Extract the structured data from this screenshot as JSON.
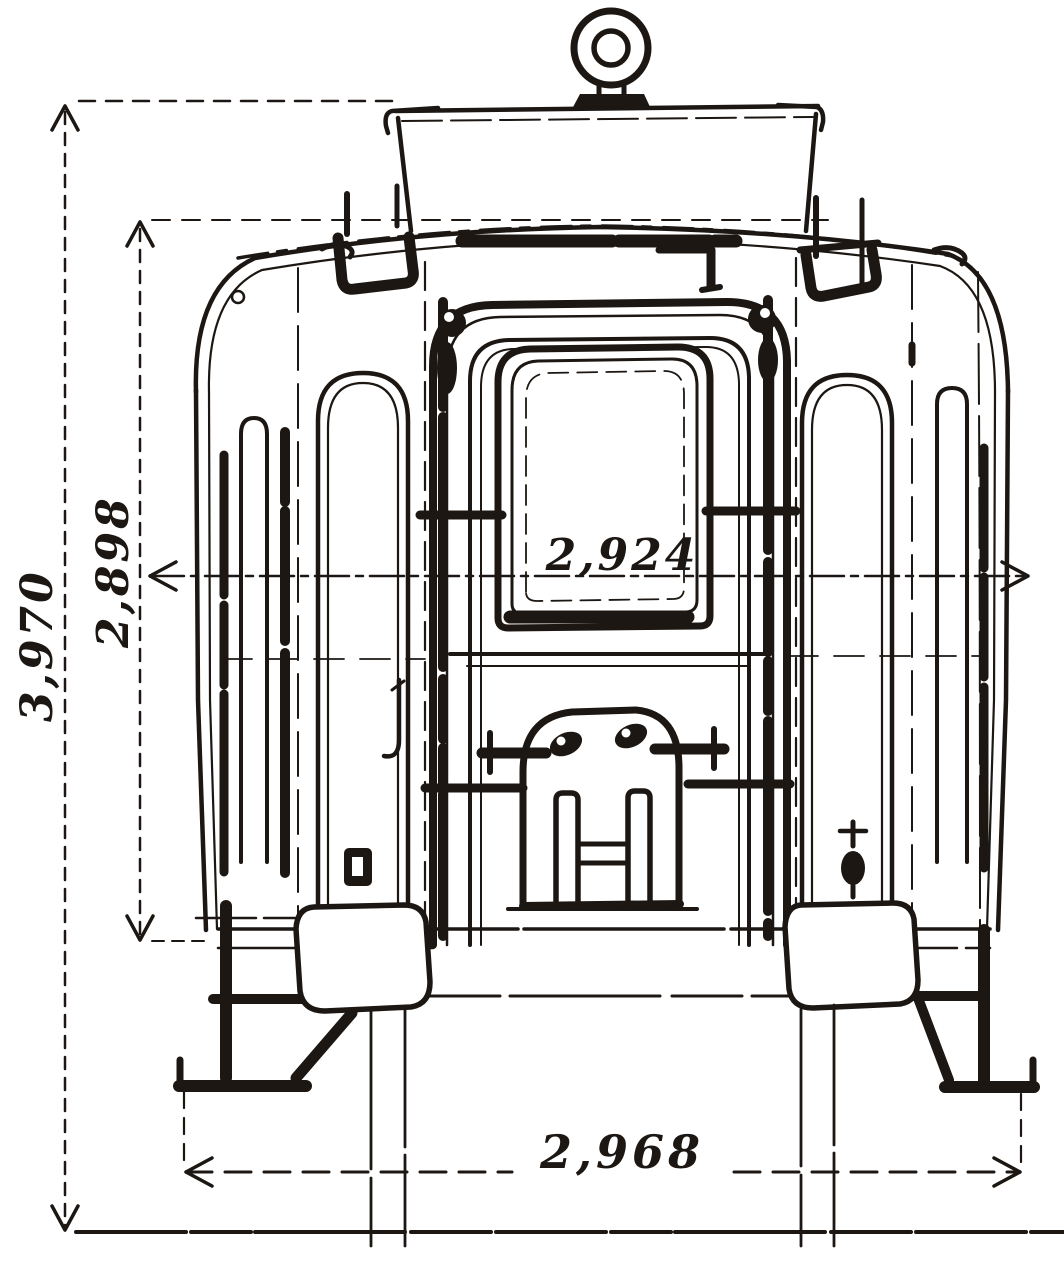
{
  "figure": {
    "type": "technical-drawing",
    "subject": "railway carriage end elevation",
    "ink_color": "#1c1712",
    "paper_color": "#ffffff"
  },
  "dimensions": {
    "overall_height": "3,970",
    "cornice_height": "2,898",
    "body_width": "2,924",
    "step_width": "2,968"
  }
}
